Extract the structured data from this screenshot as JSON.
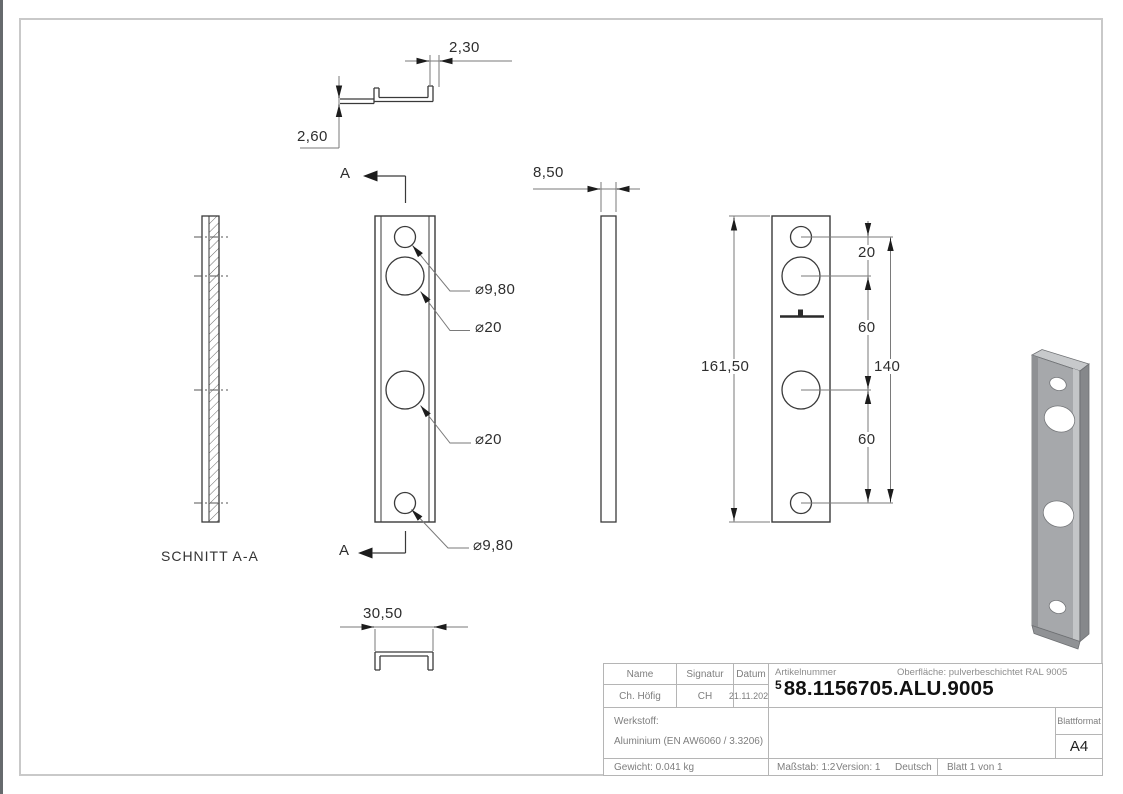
{
  "drawing": {
    "section": {
      "label": "SCHNITT A-A",
      "marker": "A"
    },
    "dimensions": {
      "lip_thickness": "2,30",
      "web_thickness": "2,60",
      "profile_depth": "8,50",
      "profile_width": "30,50",
      "total_height": "161,50",
      "top_hole_offset": "20",
      "hole_spacing_upper": "60",
      "hole_spacing_lower": "60",
      "outer_hole_span": "140",
      "dia_small_top": "⌀9,80",
      "dia_large_top": "⌀20",
      "dia_large_bottom": "⌀20",
      "dia_small_bottom": "⌀9,80"
    },
    "icons": {
      "engraving_mark": "brand-engraving-mark",
      "section_arrow": "section-cut-arrow"
    }
  },
  "title_block": {
    "name_header": "Name",
    "signature_header": "Signatur",
    "date_header": "Datum",
    "name": "Ch. Höfig",
    "signature": "CH",
    "date": "21.11.2025",
    "article_label": "Artikelnummer",
    "surface_label": "Oberfläche:",
    "surface_value": "pulverbeschichtet RAL 9005",
    "article_prefix": "5",
    "article_number": "88.1156705.ALU.9005",
    "material_label": "Werkstoff:",
    "material_value": "Aluminium (EN AW6060 / 3.3206)",
    "weight": "Gewicht: 0.041 kg",
    "scale": "Maßstab: 1:2",
    "version": "Version: 1",
    "language": "Deutsch",
    "sheet": "Blatt 1 von 1",
    "format_label": "Blattformat",
    "format": "A4"
  },
  "colors": {
    "outline": "#3a3a3a",
    "dim_line": "#7a7a7a",
    "frame": "#c9c9c9",
    "part_gray": "#a6a8ab",
    "table_border": "#b5b5b5",
    "table_text": "#7e7e7e",
    "article_text": "#111111"
  }
}
